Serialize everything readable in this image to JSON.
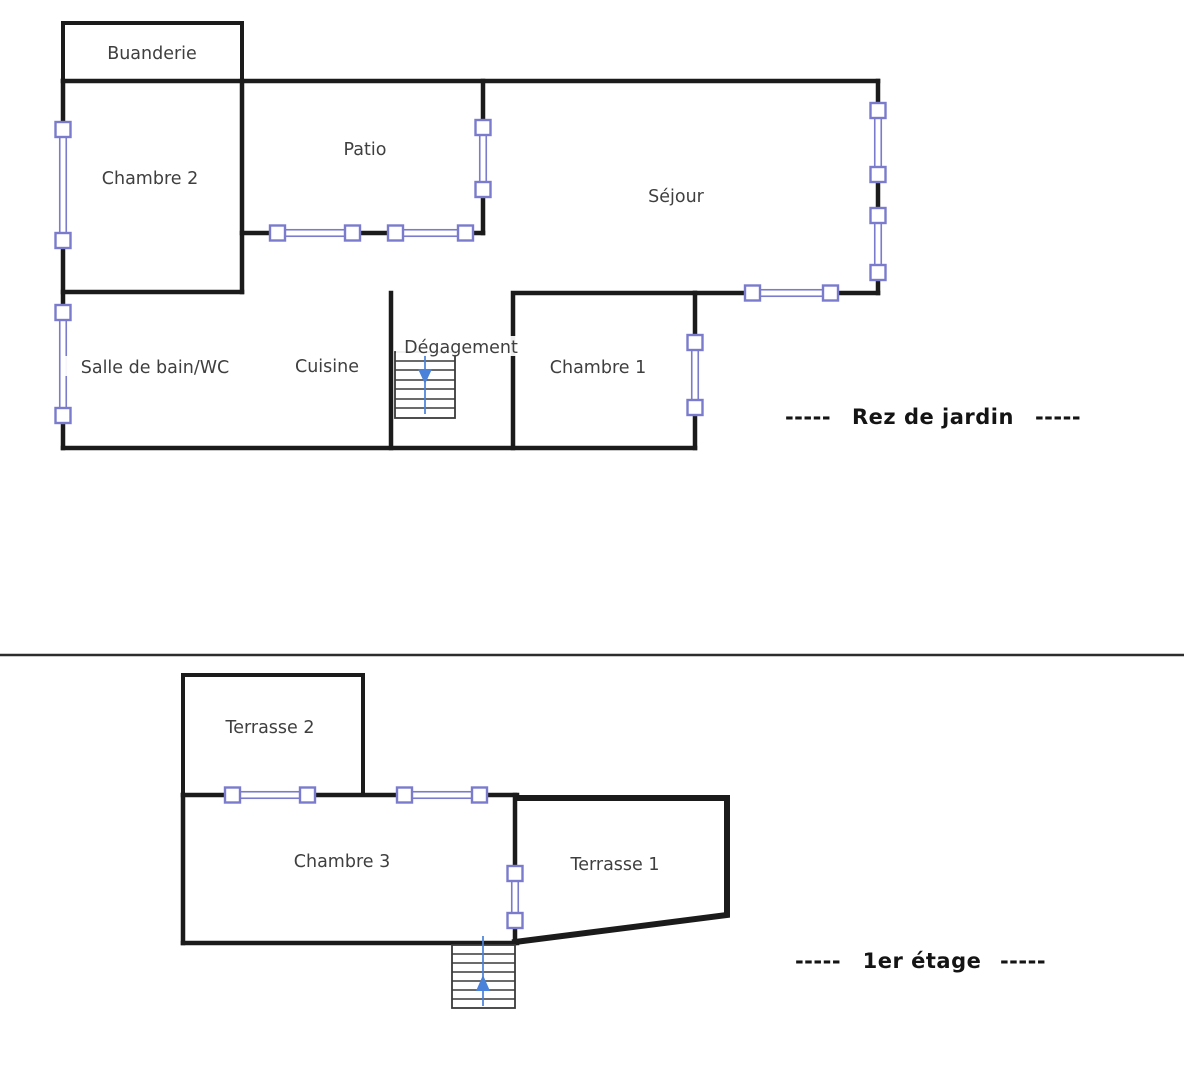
{
  "colors": {
    "wall": "#1b1b1b",
    "window": "#7b7bcd",
    "winfill": "#ffffff",
    "arrow": "#4a82d9",
    "step": "#3a3a3a",
    "label": "#3f3f3f",
    "floorlabel": "#141414",
    "divider": "#2d2d2d",
    "bg": "#ffffff"
  },
  "floors": [
    {
      "name": "Rez de jardin",
      "label": "Rez de jardin",
      "dashes_left": "-----",
      "dashes_right": "-----",
      "stairs_direction": "down",
      "rooms": [
        {
          "label": "Buanderie"
        },
        {
          "label": "Chambre 2"
        },
        {
          "label": "Patio"
        },
        {
          "label": "Séjour"
        },
        {
          "label": "Salle de bain/WC"
        },
        {
          "label": "Cuisine"
        },
        {
          "label": "Dégagement"
        },
        {
          "label": "Chambre 1"
        }
      ]
    },
    {
      "name": "1er étage",
      "label": "1er étage",
      "dashes_left": "-----",
      "dashes_right": "-----",
      "stairs_direction": "up",
      "rooms": [
        {
          "label": "Terrasse 2"
        },
        {
          "label": "Chambre 3"
        },
        {
          "label": "Terrasse 1"
        }
      ]
    }
  ]
}
